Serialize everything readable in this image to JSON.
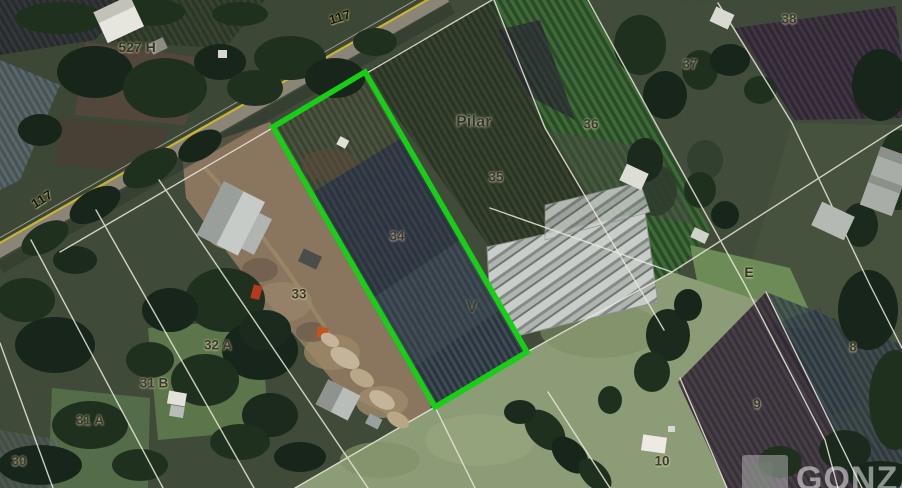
{
  "map": {
    "type": "satellite-cadastral-view",
    "highlight_color": "#17cf17",
    "road_line_color": "#c9b431",
    "boundary_line_color": "#ebe9dc",
    "labels": [
      {
        "text": "117",
        "x": 340,
        "y": 17,
        "rot": -17,
        "variant": "route"
      },
      {
        "text": "527 H",
        "x": 137,
        "y": 47,
        "rot": 0,
        "variant": "big"
      },
      {
        "text": "117",
        "x": 42,
        "y": 199,
        "rot": -33,
        "variant": "route"
      },
      {
        "text": "Pilar",
        "x": 474,
        "y": 122,
        "rot": 0,
        "variant": "place"
      },
      {
        "text": "38",
        "x": 789,
        "y": 19,
        "rot": 0,
        "variant": "lot"
      },
      {
        "text": "37",
        "x": 690,
        "y": 64,
        "rot": 0,
        "variant": "lot"
      },
      {
        "text": "36",
        "x": 591,
        "y": 124,
        "rot": 0,
        "variant": "lot"
      },
      {
        "text": "35",
        "x": 496,
        "y": 177,
        "rot": 0,
        "variant": "lot"
      },
      {
        "text": "34",
        "x": 397,
        "y": 236,
        "rot": 0,
        "variant": "lot"
      },
      {
        "text": "V",
        "x": 472,
        "y": 307,
        "rot": 0,
        "variant": "marker"
      },
      {
        "text": "33",
        "x": 299,
        "y": 294,
        "rot": 0,
        "variant": "lot"
      },
      {
        "text": "32 A",
        "x": 218,
        "y": 345,
        "rot": 0,
        "variant": "lot"
      },
      {
        "text": "31 B",
        "x": 154,
        "y": 383,
        "rot": 0,
        "variant": "lot"
      },
      {
        "text": "31 A",
        "x": 90,
        "y": 420,
        "rot": 0,
        "variant": "lot"
      },
      {
        "text": "30",
        "x": 19,
        "y": 461,
        "rot": 0,
        "variant": "lot"
      },
      {
        "text": "E",
        "x": 749,
        "y": 272,
        "rot": 0,
        "variant": "big"
      },
      {
        "text": "8",
        "x": 853,
        "y": 347,
        "rot": 0,
        "variant": "lot"
      },
      {
        "text": "9",
        "x": 757,
        "y": 404,
        "rot": 0,
        "variant": "lot"
      },
      {
        "text": "10",
        "x": 662,
        "y": 461,
        "rot": 0,
        "variant": "lot"
      }
    ],
    "watermark": {
      "text": "GONZA"
    }
  }
}
